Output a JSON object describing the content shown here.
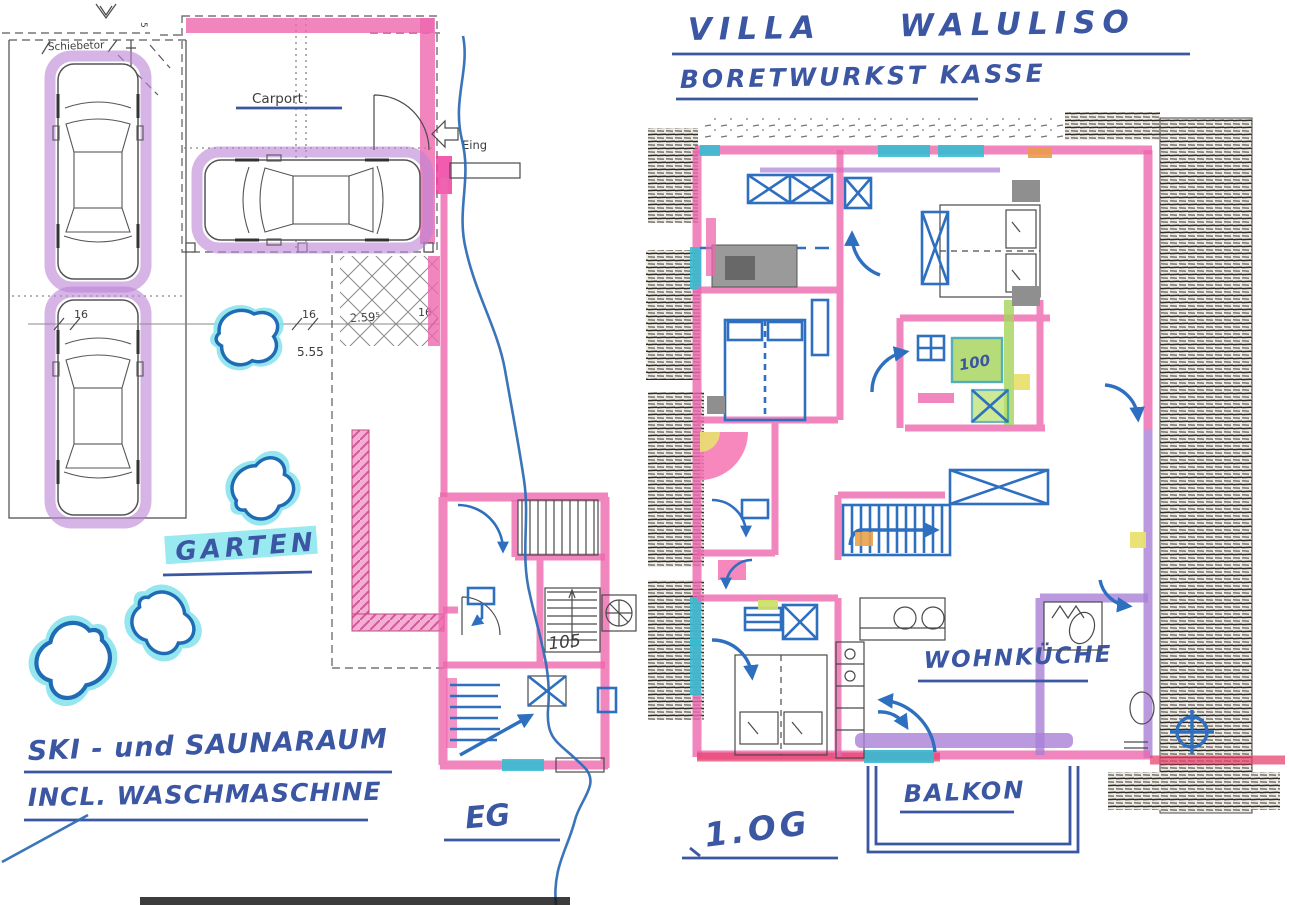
{
  "titles": {
    "line1": "VILLA WALULISO",
    "line2": "BORETWURKST KASSE"
  },
  "ground_floor": {
    "labels": {
      "gate": "Schiebetor",
      "carport": "Carport",
      "entrance": "Eing",
      "garden": "GARTEN",
      "stair_room": "105",
      "floor": "EG"
    },
    "dimensions": {
      "gate_w": "5",
      "gate_h": "6",
      "d_left": "16",
      "d_mid": "16",
      "d_terrace": "2.59⁵",
      "d_right": "16",
      "d_total": "5.55"
    },
    "notes": {
      "line1": "SKI - und SAUNARAUM",
      "line2": "INCL. WASCHMASCHINE"
    }
  },
  "upper_floor": {
    "labels": {
      "floor": "1.OG",
      "kitchen": "WOHNKÜCHE",
      "balcony": "BALKON",
      "shower": "100"
    }
  },
  "colors": {
    "pen_blue": "#3b56a2",
    "marker_pink": "#ee67ae",
    "marker_hot_pink": "#ee3fa0",
    "marker_purple": "#a97fd6",
    "car_highlight_purple": "#bb84d6",
    "marker_cyan": "#7ee3ec",
    "window_teal": "#35bcd0",
    "furniture_blue": "#2e6fc0",
    "highlight_green": "#a5d45a",
    "highlight_yellow": "#e9e070",
    "highlight_orange": "#eb9a4e",
    "accent_red": "#e8436e",
    "ink": "#4a4a4a"
  }
}
